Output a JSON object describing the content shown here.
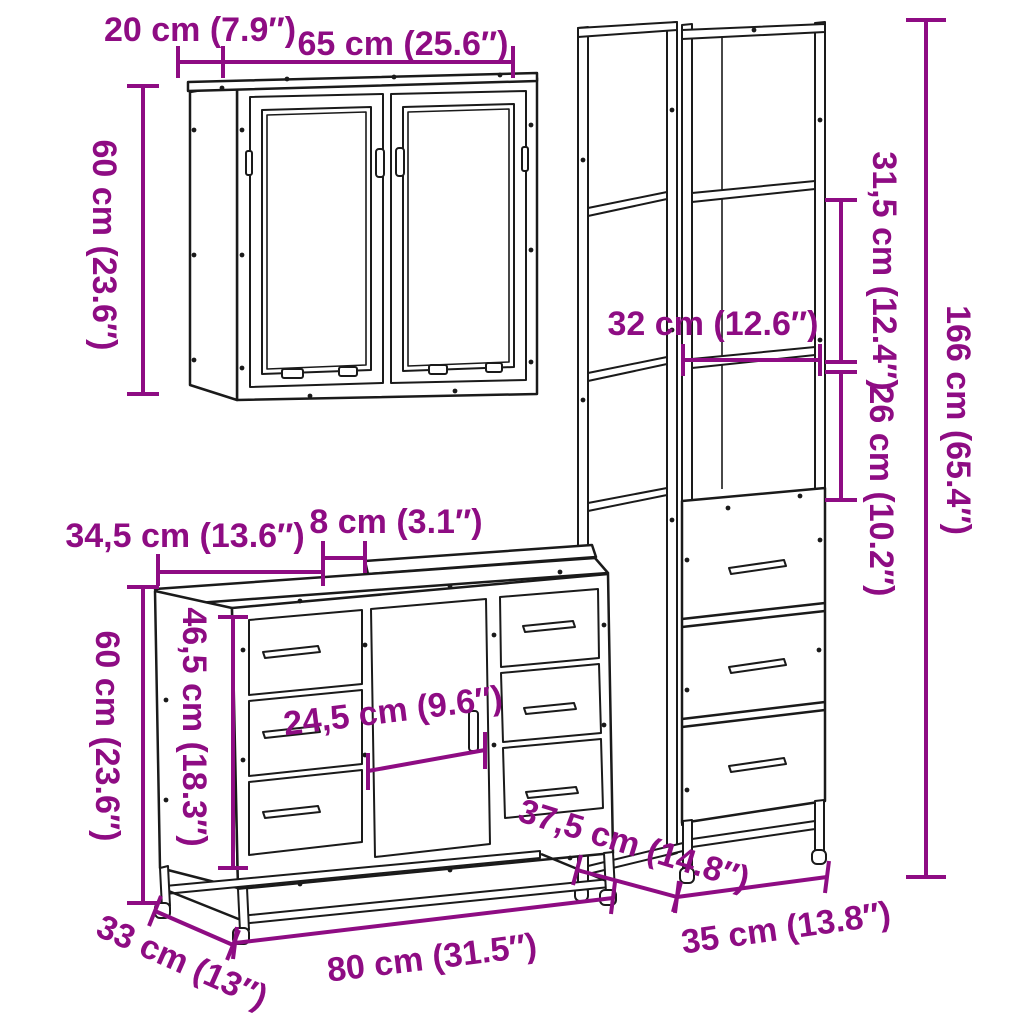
{
  "colors": {
    "dimension_annotation": "#8E0C83",
    "line_art": "#1A1A1A",
    "background": "#FFFFFF"
  },
  "labels": {
    "wall_cabinet": {
      "depth": "20 cm (7.9″)",
      "width": "65 cm (25.6″)",
      "height": "60 cm (23.6″)"
    },
    "tall_cabinet": {
      "upper_shelf_gap": "31,5 cm (12.4″)",
      "shelf_width": "32 cm (12.6″)",
      "lower_shelf_gap": "26 cm (10.2″)",
      "height": "166 cm (65.4″)",
      "depth": "37,5 cm (14.8″)",
      "width": "35 cm (13.8″)"
    },
    "sink_cabinet": {
      "top_left_width": "34,5 cm (13.6″)",
      "top_gap": "8 cm (3.1″)",
      "side_height": "46,5 cm (18.3″)",
      "height": "60 cm (23.6″)",
      "door_width": "24,5 cm (9.6″)",
      "depth": "33 cm (13″)",
      "width": "80 cm (31.5″)"
    }
  }
}
